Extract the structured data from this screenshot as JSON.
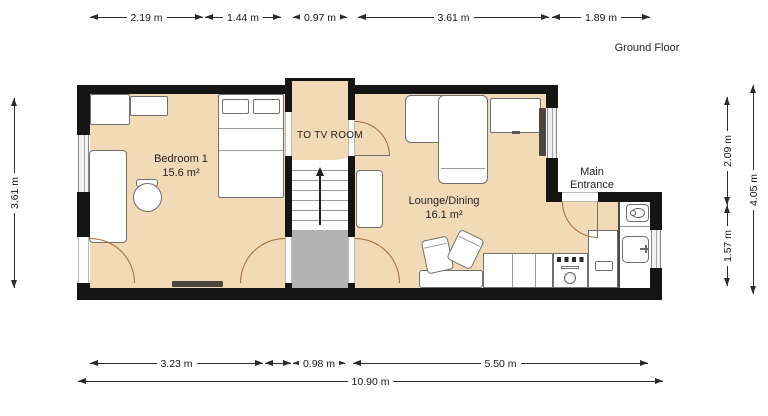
{
  "title": "Ground Floor",
  "rooms": {
    "bedroom": {
      "name": "Bedroom 1",
      "area": "15.6 m²"
    },
    "lounge": {
      "name": "Lounge/Dining",
      "area": "16.1 m²"
    }
  },
  "labels": {
    "corridor": "TO TV ROOM",
    "entrance_line1": "Main",
    "entrance_line2": "Entrance"
  },
  "dimensions": {
    "top": [
      "2.19 m",
      "1.44 m",
      "0.97 m",
      "3.61 m",
      "1.89 m"
    ],
    "left": [
      "3.61 m"
    ],
    "right_inner": [
      "2.09 m",
      "1.57 m"
    ],
    "right_outer": [
      "4.05 m"
    ],
    "bottom": [
      "3.23 m",
      "0.98 m",
      "5.50 m"
    ],
    "total_width": "10.90 m"
  },
  "colors": {
    "floor": "#f3dab6",
    "wall": "#151515",
    "landing": "#b3b3b3",
    "radiator": "#4c473e",
    "arc": "#9a6a3a",
    "dim": "#2b2b2b"
  }
}
